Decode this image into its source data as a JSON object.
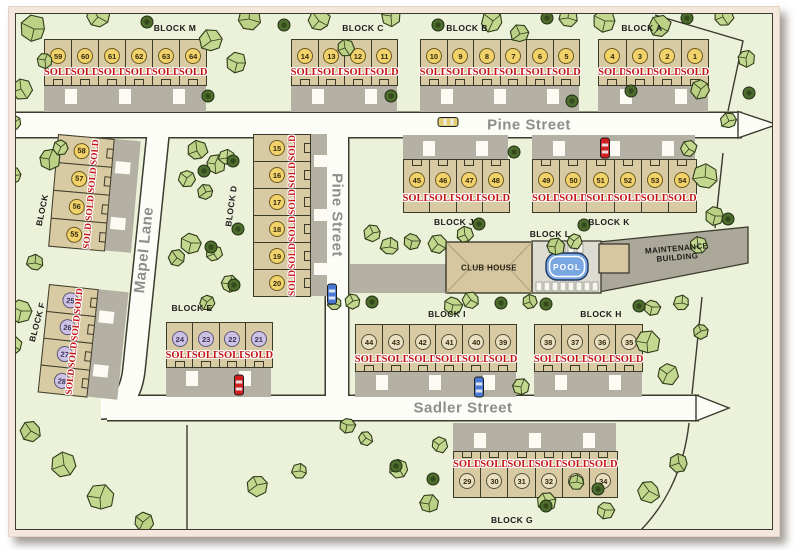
{
  "streets": {
    "pine": "Pine Street",
    "pine_vertical": "Pine Street",
    "mapel": "Mapel Lane",
    "sadler": "Sadler Street"
  },
  "facilities": {
    "club_house": "CLUB HOUSE",
    "pool": "POOL",
    "maintenance_line1": "MAINTENANCE",
    "maintenance_line2": "BUILDING",
    "block_l_label": "BLOCK L"
  },
  "blocks": [
    {
      "id": "M",
      "label": "BLOCK M",
      "circle": "yellow",
      "lots": [
        {
          "number": "59",
          "status": "SOLD"
        },
        {
          "number": "60",
          "status": "SOLD"
        },
        {
          "number": "61",
          "status": "SOLD"
        },
        {
          "number": "62",
          "status": "SOLD"
        },
        {
          "number": "63",
          "status": "SOLD"
        },
        {
          "number": "64",
          "status": "SOLD"
        }
      ]
    },
    {
      "id": "C",
      "label": "BLOCK C",
      "circle": "yellow",
      "lots": [
        {
          "number": "14",
          "status": "SOLD"
        },
        {
          "number": "13",
          "status": "SOLD"
        },
        {
          "number": "12",
          "status": "SOLD"
        },
        {
          "number": "11",
          "status": "SOLD"
        }
      ]
    },
    {
      "id": "B",
      "label": "BLOCK B",
      "circle": "yellow",
      "lots": [
        {
          "number": "10",
          "status": "SOLD"
        },
        {
          "number": "9",
          "status": "SOLD"
        },
        {
          "number": "8",
          "status": "SOLD"
        },
        {
          "number": "7",
          "status": "SOLD"
        },
        {
          "number": "6",
          "status": "SOLD"
        },
        {
          "number": "5",
          "status": "SOLD"
        }
      ]
    },
    {
      "id": "A",
      "label": "BLOCK A",
      "circle": "yellow",
      "lots": [
        {
          "number": "4",
          "status": "SOLD"
        },
        {
          "number": "3",
          "status": "SOLD"
        },
        {
          "number": "2",
          "status": "SOLD"
        },
        {
          "number": "1",
          "status": "SOLD"
        }
      ]
    },
    {
      "id": "N",
      "label": "BLOCK",
      "circle": "yellow",
      "lots": [
        {
          "number": "58",
          "status": "SOLD"
        },
        {
          "number": "57",
          "status": "SOLD"
        },
        {
          "number": "56",
          "status": "SOLD"
        },
        {
          "number": "55",
          "status": "SOLD"
        }
      ]
    },
    {
      "id": "D",
      "label": "BLOCK D",
      "circle": "yellow",
      "lots": [
        {
          "number": "15",
          "status": "SOLD"
        },
        {
          "number": "16",
          "status": "SOLD"
        },
        {
          "number": "17",
          "status": "SOLD"
        },
        {
          "number": "18",
          "status": "SOLD"
        },
        {
          "number": "19",
          "status": "SOLD"
        },
        {
          "number": "20",
          "status": "SOLD"
        }
      ]
    },
    {
      "id": "F",
      "label": "BLOCK F",
      "circle": "purple",
      "lots": [
        {
          "number": "25",
          "status": "SOLD"
        },
        {
          "number": "26",
          "status": "SOLD"
        },
        {
          "number": "27",
          "status": "SOLD"
        },
        {
          "number": "28",
          "status": "SOLD"
        }
      ]
    },
    {
      "id": "E",
      "label": "BLOCK E",
      "circle": "purple",
      "lots": [
        {
          "number": "24",
          "status": "SOLD"
        },
        {
          "number": "23",
          "status": "SOLD"
        },
        {
          "number": "22",
          "status": "SOLD"
        },
        {
          "number": "21",
          "status": "SOLD"
        }
      ]
    },
    {
      "id": "J",
      "label": "BLOCK J",
      "circle": "yellow",
      "lots": [
        {
          "number": "45",
          "status": "SOLD"
        },
        {
          "number": "46",
          "status": "SOLD"
        },
        {
          "number": "47",
          "status": "SOLD"
        },
        {
          "number": "48",
          "status": "SOLD"
        }
      ]
    },
    {
      "id": "K",
      "label": "BLOCK K",
      "circle": "yellow",
      "lots": [
        {
          "number": "49",
          "status": "SOLD"
        },
        {
          "number": "50",
          "status": "SOLD"
        },
        {
          "number": "51",
          "status": "SOLD"
        },
        {
          "number": "52",
          "status": "SOLD"
        },
        {
          "number": "53",
          "status": "SOLD"
        },
        {
          "number": "54",
          "status": "SOLD"
        }
      ]
    },
    {
      "id": "I",
      "label": "BLOCK I",
      "circle": "tan",
      "lots": [
        {
          "number": "44",
          "status": "SOLD"
        },
        {
          "number": "43",
          "status": "SOLD"
        },
        {
          "number": "42",
          "status": "SOLD"
        },
        {
          "number": "41",
          "status": "SOLD"
        },
        {
          "number": "40",
          "status": "SOLD"
        },
        {
          "number": "39",
          "status": "SOLD"
        }
      ]
    },
    {
      "id": "H",
      "label": "BLOCK H",
      "circle": "tan",
      "lots": [
        {
          "number": "38",
          "status": "SOLD"
        },
        {
          "number": "37",
          "status": "SOLD"
        },
        {
          "number": "36",
          "status": "SOLD"
        },
        {
          "number": "35",
          "status": "SOLD"
        }
      ]
    },
    {
      "id": "G",
      "label": "BLOCK G",
      "circle": "tan",
      "lots": [
        {
          "number": "29",
          "status": "SOLD"
        },
        {
          "number": "30",
          "status": "SOLD"
        },
        {
          "number": "31",
          "status": "SOLD"
        },
        {
          "number": "32",
          "status": "SOLD"
        },
        {
          "number": "33",
          "status": "SOLD"
        },
        {
          "number": "34",
          "status": "SOLD"
        }
      ]
    }
  ],
  "vehicles": [
    {
      "name": "yellow-car",
      "color": "#e3cd72",
      "x": 447,
      "y": 121,
      "vertical": false
    },
    {
      "name": "red-car",
      "color": "#cf1f1f",
      "x": 604,
      "y": 147,
      "vertical": true
    },
    {
      "name": "blue-car",
      "color": "#4a79d4",
      "x": 331,
      "y": 293,
      "vertical": true
    },
    {
      "name": "red-car",
      "color": "#cf1f1f",
      "x": 238,
      "y": 384,
      "vertical": true
    },
    {
      "name": "blue-car",
      "color": "#4a79d4",
      "x": 478,
      "y": 386,
      "vertical": true
    }
  ],
  "trees": {
    "canopies": [
      [
        33,
        28,
        13
      ],
      [
        97,
        16,
        12
      ],
      [
        20,
        88,
        11
      ],
      [
        44,
        59,
        8
      ],
      [
        13,
        122,
        8
      ],
      [
        210,
        40,
        11
      ],
      [
        248,
        18,
        11
      ],
      [
        236,
        62,
        10
      ],
      [
        318,
        20,
        11
      ],
      [
        344,
        47,
        9
      ],
      [
        390,
        15,
        10
      ],
      [
        492,
        20,
        11
      ],
      [
        519,
        33,
        9
      ],
      [
        567,
        17,
        9
      ],
      [
        604,
        20,
        11
      ],
      [
        659,
        26,
        11
      ],
      [
        722,
        16,
        10
      ],
      [
        745,
        57,
        9
      ],
      [
        700,
        88,
        10
      ],
      [
        728,
        120,
        8
      ],
      [
        704,
        176,
        12
      ],
      [
        714,
        215,
        9
      ],
      [
        688,
        148,
        8
      ],
      [
        697,
        245,
        9
      ],
      [
        48,
        158,
        11
      ],
      [
        60,
        146,
        8
      ],
      [
        12,
        175,
        9
      ],
      [
        34,
        262,
        8
      ],
      [
        20,
        310,
        11
      ],
      [
        12,
        345,
        9
      ],
      [
        196,
        150,
        10
      ],
      [
        214,
        163,
        10
      ],
      [
        186,
        177,
        9
      ],
      [
        205,
        191,
        8
      ],
      [
        226,
        157,
        8
      ],
      [
        190,
        242,
        10
      ],
      [
        176,
        257,
        8
      ],
      [
        213,
        253,
        8
      ],
      [
        228,
        283,
        9
      ],
      [
        206,
        301,
        8
      ],
      [
        372,
        232,
        9
      ],
      [
        389,
        246,
        9
      ],
      [
        411,
        240,
        8
      ],
      [
        437,
        243,
        9
      ],
      [
        464,
        234,
        8
      ],
      [
        554,
        246,
        9
      ],
      [
        573,
        240,
        8
      ],
      [
        352,
        300,
        8
      ],
      [
        334,
        303,
        7
      ],
      [
        452,
        304,
        9
      ],
      [
        470,
        299,
        8
      ],
      [
        529,
        301,
        7
      ],
      [
        646,
        342,
        12
      ],
      [
        666,
        373,
        11
      ],
      [
        700,
        330,
        8
      ],
      [
        681,
        302,
        8
      ],
      [
        651,
        306,
        8
      ],
      [
        30,
        430,
        10
      ],
      [
        63,
        464,
        12
      ],
      [
        99,
        497,
        13
      ],
      [
        142,
        521,
        10
      ],
      [
        256,
        484,
        11
      ],
      [
        299,
        470,
        8
      ],
      [
        346,
        424,
        8
      ],
      [
        365,
        437,
        7
      ],
      [
        398,
        468,
        9
      ],
      [
        428,
        503,
        9
      ],
      [
        438,
        444,
        8
      ],
      [
        545,
        500,
        10
      ],
      [
        576,
        481,
        8
      ],
      [
        604,
        509,
        9
      ],
      [
        648,
        490,
        11
      ],
      [
        678,
        462,
        9
      ],
      [
        520,
        386,
        8
      ]
    ],
    "bushes": [
      [
        146,
        21
      ],
      [
        283,
        24
      ],
      [
        207,
        95
      ],
      [
        390,
        95
      ],
      [
        437,
        24
      ],
      [
        546,
        17
      ],
      [
        686,
        17
      ],
      [
        571,
        100
      ],
      [
        630,
        90
      ],
      [
        232,
        160
      ],
      [
        203,
        170
      ],
      [
        237,
        228
      ],
      [
        210,
        246
      ],
      [
        233,
        284
      ],
      [
        513,
        151
      ],
      [
        478,
        223
      ],
      [
        583,
        224
      ],
      [
        545,
        303
      ],
      [
        500,
        302
      ],
      [
        638,
        305
      ],
      [
        395,
        465
      ],
      [
        432,
        478
      ],
      [
        545,
        505
      ],
      [
        597,
        488
      ],
      [
        727,
        218
      ],
      [
        748,
        92
      ],
      [
        371,
        301
      ]
    ]
  },
  "colors": {
    "map_bg": "#ecf1d9",
    "street": "#fdfdf8",
    "street_casing": "#3c3b2f",
    "street_label": "#8d8d8d",
    "lot_fill": "#d8caa3",
    "lot_border": "#3c3a29",
    "driveway": "#b4b1a4",
    "sold": "#c41414",
    "circle_yellow": "#f2d26a",
    "circle_yellow_border": "#6b5a20",
    "circle_purple": "#cdc2e4",
    "circle_purple_border": "#5e5678",
    "circle_tan": "#e9e0c2",
    "circle_tan_border": "#56513b",
    "tree": "#c4d78f",
    "tree_outline": "#2c3b18",
    "bush": "#4d6c2d",
    "pool_water": "#79a7e2",
    "building": "#d6c7a1",
    "frame": "#f4e8dd"
  }
}
